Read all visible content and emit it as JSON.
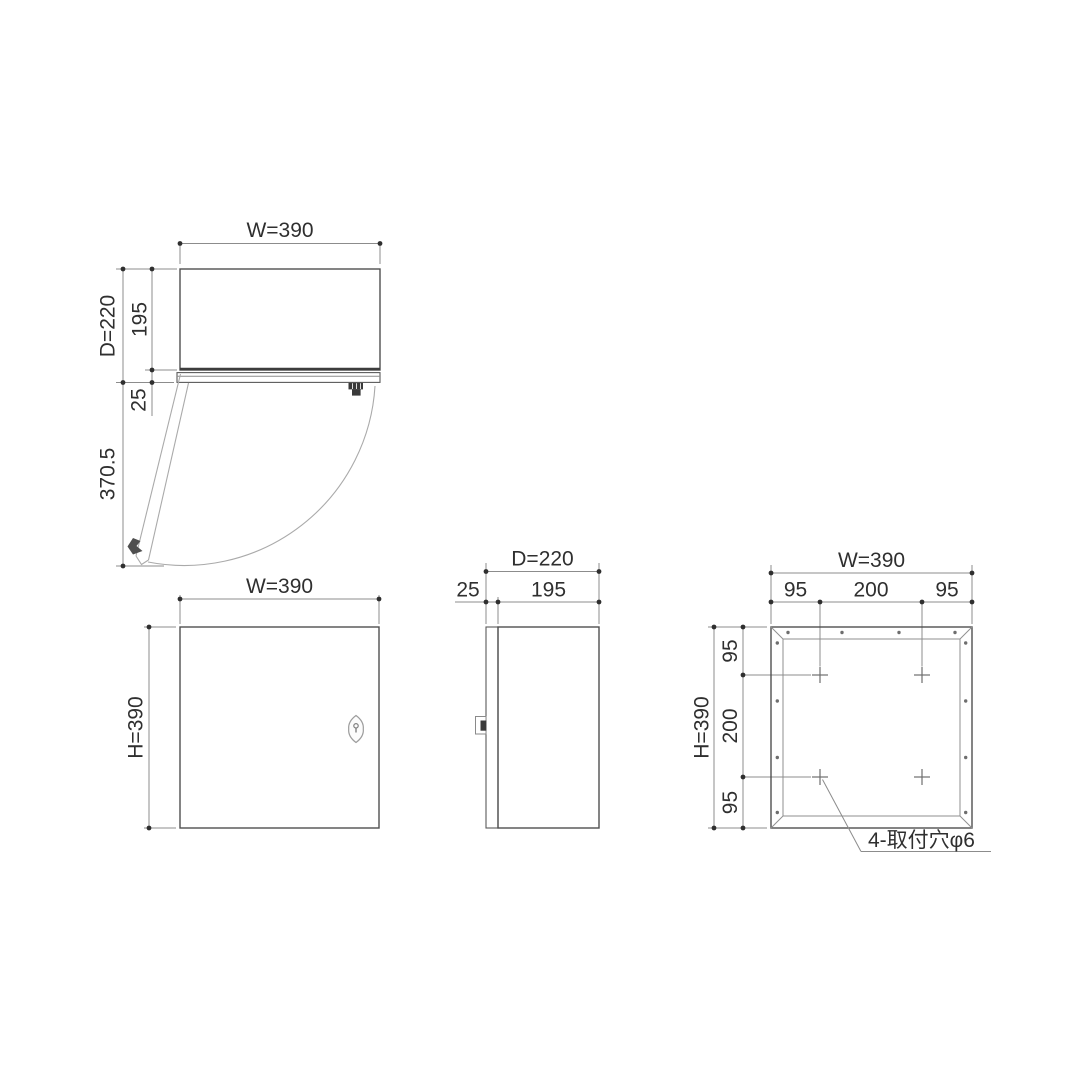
{
  "drawing": {
    "top_view": {
      "dim_width": "W=390",
      "dim_depth_total": "D=220",
      "dim_depth_body": "195",
      "dim_door_thickness": "25",
      "dim_door_swing": "370.5"
    },
    "front_view": {
      "dim_width": "W=390",
      "dim_height": "H=390"
    },
    "side_view": {
      "dim_depth_total": "D=220",
      "dim_door_thickness": "25",
      "dim_depth_body": "195"
    },
    "rear_view": {
      "dim_width": "W=390",
      "dim_height": "H=390",
      "dim_top": [
        "95",
        "200",
        "95"
      ],
      "dim_left": [
        "95",
        "200",
        "95"
      ],
      "hole_note": "4-取付穴φ6"
    },
    "colors": {
      "background": "#ffffff",
      "outline": "#4f4f4f",
      "dimension_line": "#8c8c8c",
      "text": "#2f2f2f",
      "construction": "#aaaaaa"
    }
  }
}
